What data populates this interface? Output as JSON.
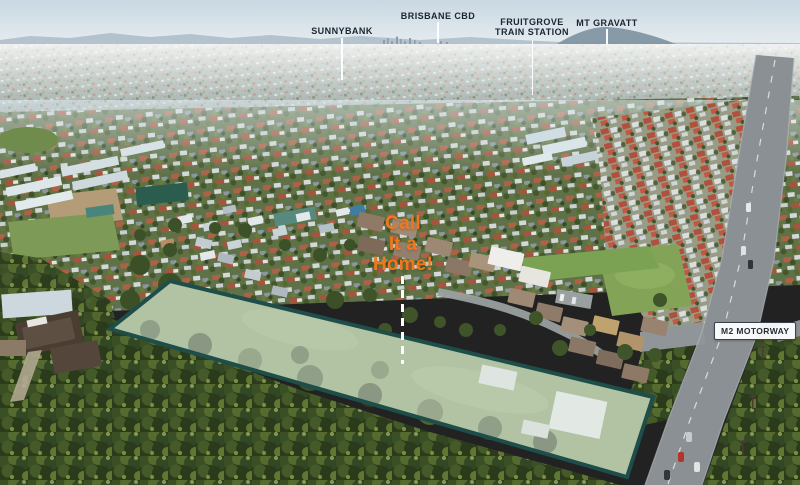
{
  "labels": {
    "sunnybank": "SUNNYBANK",
    "brisbane_cbd": "BRISBANE CBD",
    "fruitgrove_line1": "FRUITGROVE",
    "fruitgrove_line2": "TRAIN STATION",
    "mt_gravatt": "MT GRAVATT",
    "m2_motorway": "M2 MOTORWAY"
  },
  "callout": {
    "line1": "Call",
    "line2": "It a",
    "line3": "Home!"
  },
  "colors": {
    "place_label_text": "#1b2531",
    "callout_text": "#f2771c",
    "pointer_line": "#ffffff",
    "parcel_border": "#1e4e4a",
    "parcel_fill": "rgba(225,234,229,0.52)",
    "motorway_badge_bg": "#ffffff",
    "motorway_badge_text": "#242e3a"
  }
}
